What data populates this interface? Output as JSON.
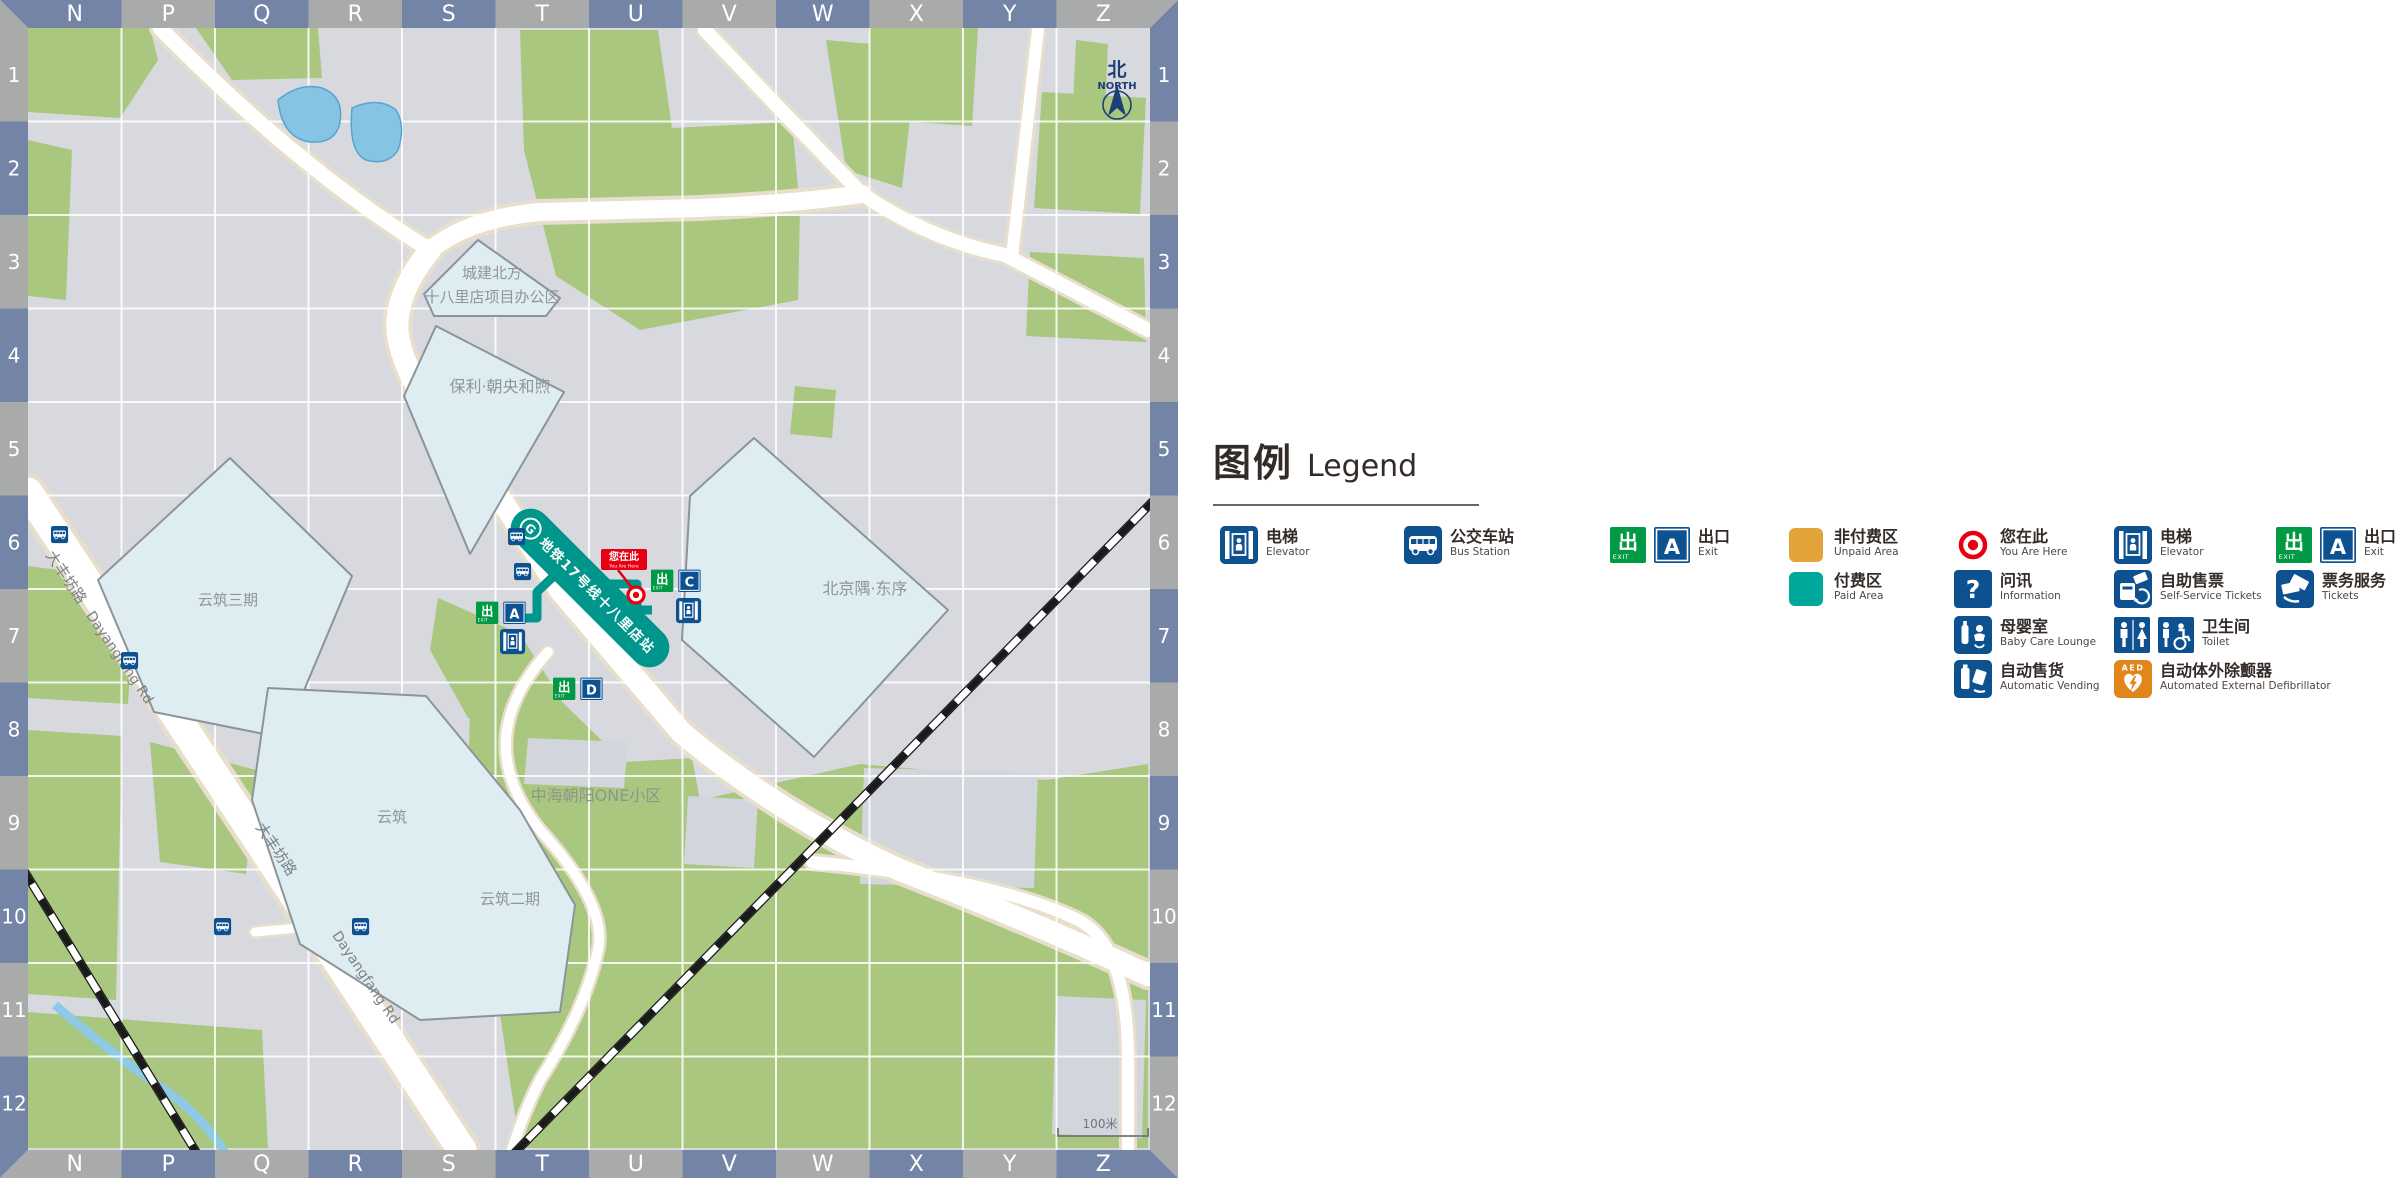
{
  "map": {
    "grid": {
      "columns": [
        "N",
        "P",
        "Q",
        "R",
        "S",
        "T",
        "U",
        "V",
        "W",
        "X",
        "Y",
        "Z"
      ],
      "rows": [
        "1",
        "2",
        "3",
        "4",
        "5",
        "6",
        "7",
        "8",
        "9",
        "10",
        "11",
        "12"
      ]
    },
    "north": {
      "zh": "北",
      "en": "NORTH"
    },
    "scale_label": "100米",
    "station": {
      "line_label": "地铁17号线十八里店站"
    },
    "you_are_here": {
      "zh": "您在此",
      "en": "You Are Here"
    },
    "exits": [
      {
        "letter": "A"
      },
      {
        "letter": "C"
      },
      {
        "letter": "D"
      }
    ],
    "buildings": [
      {
        "label": "城建北方",
        "label2": "十八里店项目办公区"
      },
      {
        "label": "保利·朝央和煦"
      },
      {
        "label": "北京隅·东序"
      },
      {
        "label": "云筑三期"
      },
      {
        "label": "云筑"
      },
      {
        "label": "云筑二期"
      }
    ],
    "area_label": "中海朝阳ONE小区",
    "road": {
      "zh": "大丰坊路",
      "en": "Dayangfang Rd"
    }
  },
  "legend": {
    "title_zh": "图例",
    "title_en": "Legend",
    "columns": [
      [
        {
          "icon": "elevator",
          "zh": "电梯",
          "en": "Elevator"
        }
      ],
      [
        {
          "icon": "bus",
          "zh": "公交车站",
          "en": "Bus Station"
        }
      ],
      [
        {
          "icon": "exit",
          "letter": "A",
          "zh": "出口",
          "en": "Exit"
        }
      ],
      [
        {
          "icon": "unpaid",
          "zh": "非付费区",
          "en": "Unpaid Area"
        },
        {
          "icon": "paid",
          "zh": "付费区",
          "en": "Paid Area"
        }
      ],
      [
        {
          "icon": "here",
          "zh": "您在此",
          "en": "You Are Here"
        },
        {
          "icon": "info",
          "zh": "问讯",
          "en": "Information"
        },
        {
          "icon": "baby",
          "zh": "母婴室",
          "en": "Baby Care Lounge"
        },
        {
          "icon": "vending",
          "zh": "自动售货",
          "en": "Automatic Vending"
        }
      ],
      [
        {
          "icon": "elevator",
          "zh": "电梯",
          "en": "Elevator"
        },
        {
          "icon": "ticketmachine",
          "zh": "自助售票",
          "en": "Self-Service Tickets"
        },
        {
          "icon": "toilet",
          "zh": "卫生间",
          "en": "Toilet"
        },
        {
          "icon": "aed",
          "zh": "自动体外除颤器",
          "en": "Automated External Defibrillator"
        }
      ],
      [
        {
          "icon": "exit",
          "letter": "A",
          "zh": "出口",
          "en": "Exit"
        },
        {
          "icon": "tickets",
          "zh": "票务服务",
          "en": "Tickets"
        }
      ]
    ]
  },
  "colors": {
    "border_blue": "#7384A6",
    "border_gray": "#A9ABAA",
    "map_base": "#D7D9DF",
    "block_gray": "#D2D5DC",
    "green": "#A9C77E",
    "building_fill": "#DDEDF1",
    "building_stroke": "#8D9499",
    "road_fill": "#FFFFFF",
    "road_casing": "#E7DECB",
    "water": "#85C4E3",
    "water_stroke": "#56A4CF",
    "station_teal": "#00968B",
    "icon_navy": "#0E5190",
    "exit_green": "#009A44",
    "red": "#E60012",
    "unpaid_orange": "#E3A33B",
    "paid_teal": "#00A89B",
    "aed_orange": "#E0861A",
    "label_gray": "#8F969B",
    "road_label": "#7B8287"
  }
}
